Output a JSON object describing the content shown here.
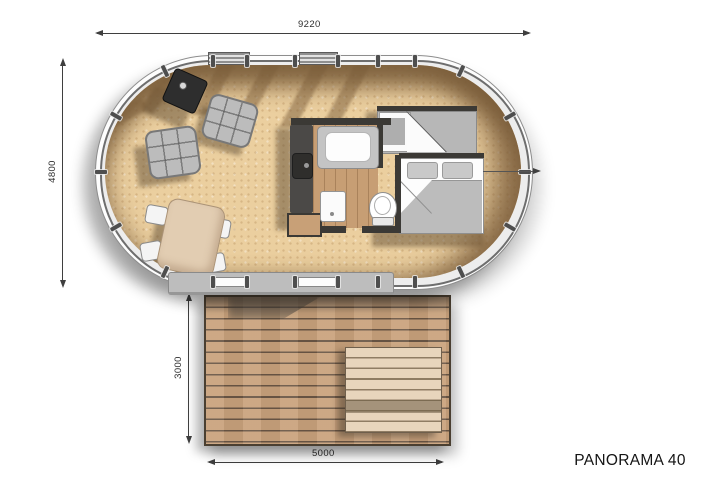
{
  "title": "PANORAMA 40",
  "dimensions": {
    "building_width": "9220",
    "building_depth": "4800",
    "deck_depth": "3000",
    "deck_width": "5000"
  },
  "colors": {
    "floor": "#ebcf9f",
    "floor_shadow_band": "#8f6f49",
    "deck_wood": "#c9a27c",
    "deck_gap": "#6a5645",
    "lounger_wood": "#e8d5bc",
    "counter_dark": "#4b4947",
    "wall_dark": "#3b3935",
    "furniture_gray": "#b7b7b7",
    "dimension_line": "#3f3f3f",
    "title_text": "#141414"
  },
  "fixtures": [
    "wood-stove",
    "lounge-chair",
    "lounge-chair",
    "dining-table",
    "dining-chairs",
    "kitchen-counter",
    "kitchen-sink",
    "bathtub",
    "washbasin",
    "toilet",
    "wardrobe",
    "double-bed",
    "deck",
    "deck-lounger",
    "glazed-oval-wall"
  ]
}
